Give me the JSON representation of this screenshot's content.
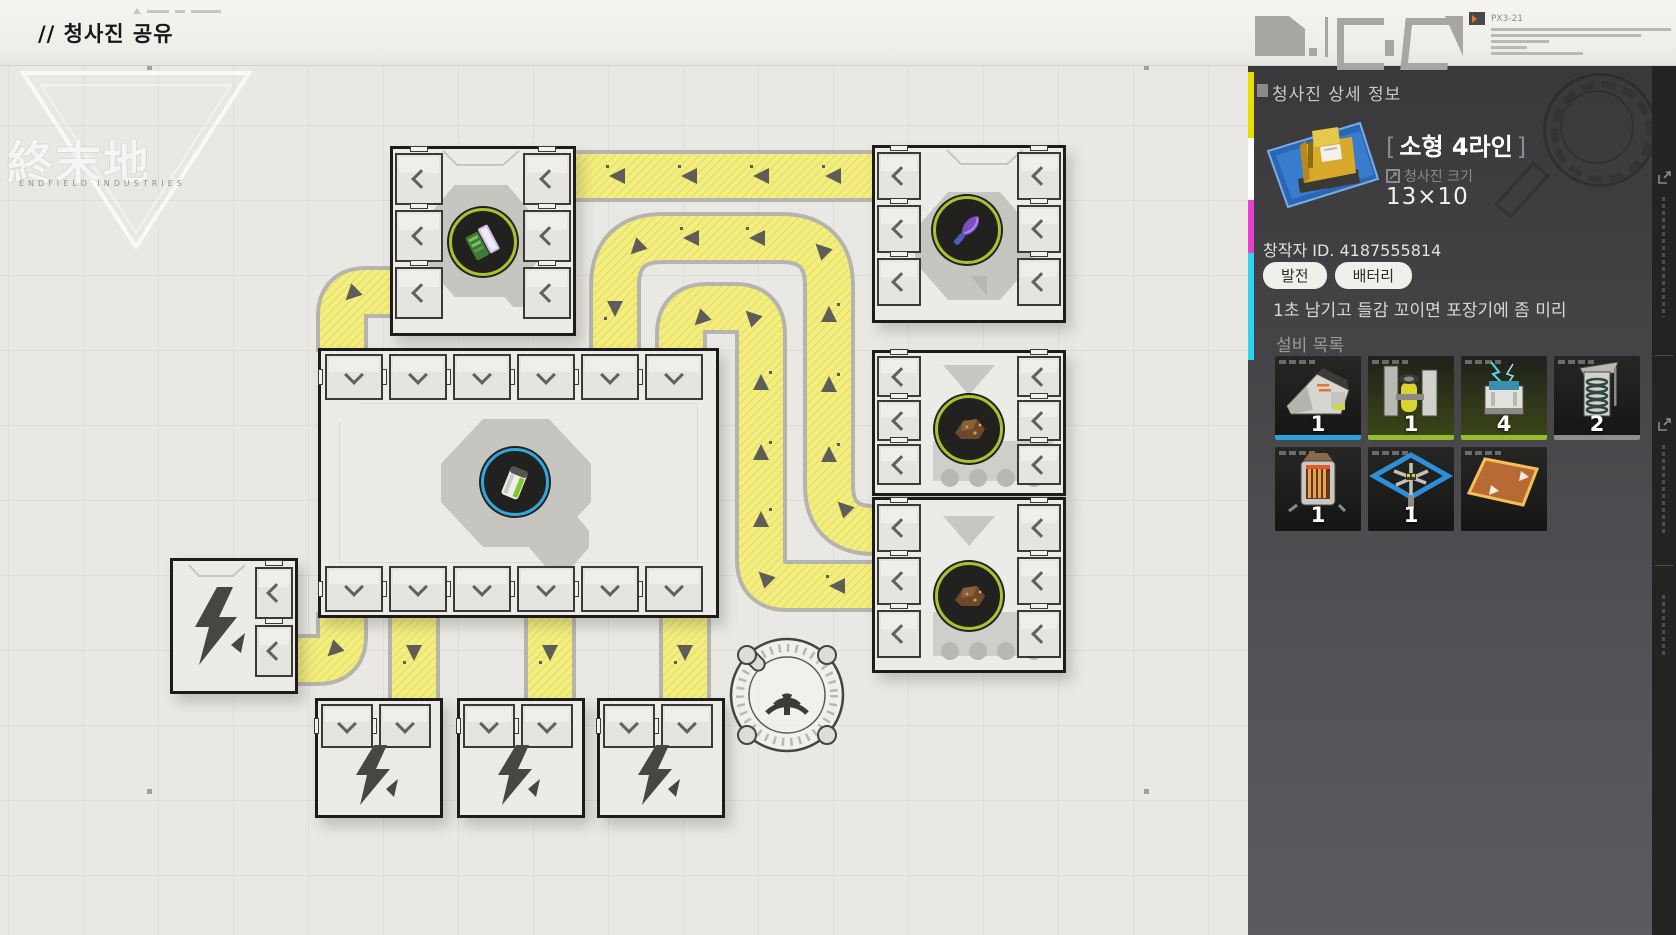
{
  "window": {
    "title": "// 청사진 공유"
  },
  "logo": {
    "cjk": "終末地",
    "subtitle": "ENDFIELD INDUSTRIES"
  },
  "topbar_deco": {
    "code": "PX3-21"
  },
  "panel": {
    "section_title": "청사진 상세 정보",
    "blueprint": {
      "bracket_open": "[",
      "name": "소형 4라인",
      "bracket_close": "]",
      "size_label": "청사진 크기",
      "size_value": "13×10"
    },
    "creator_id": "창작자 ID. 4187555814",
    "tags": [
      "발전",
      "배터리"
    ],
    "description": "1초 남기고 들감 꼬이면 포장기에 좀 미리",
    "equipment_title": "설비 목록",
    "equipment": [
      {
        "name": "crusher",
        "count": "1",
        "bar_color": "#2ba2dc"
      },
      {
        "name": "battery-assembler",
        "count": "1",
        "bar_color": "#96bc2e"
      },
      {
        "name": "generator",
        "count": "4",
        "bar_color": "#96bc2e"
      },
      {
        "name": "storage-tower",
        "count": "2",
        "bar_color": "#8e8e8c"
      },
      {
        "name": "heater",
        "count": "1",
        "bar_color": ""
      },
      {
        "name": "packager",
        "count": "1",
        "bar_color": ""
      },
      {
        "name": "conveyor-patch",
        "count": "",
        "bar_color": ""
      }
    ],
    "accent_bars": [
      "#e8df00",
      "#ffffff",
      "#e83fd0",
      "#2fd4f0"
    ]
  },
  "map": {
    "belt_color": "#f4ee7e",
    "buildings": [
      {
        "name": "assembler-top-left",
        "item": "green-circuit"
      },
      {
        "name": "assembler-top-right",
        "item": "purple-plant"
      },
      {
        "name": "smelter-mid-right",
        "item": "ore"
      },
      {
        "name": "smelter-bottom-right",
        "item": "ore"
      },
      {
        "name": "main-factory-center",
        "item": "battery"
      },
      {
        "name": "power-plant-left",
        "icon": "lightning"
      },
      {
        "name": "power-plant-1",
        "icon": "lightning"
      },
      {
        "name": "power-plant-2",
        "icon": "lightning"
      },
      {
        "name": "power-plant-3",
        "icon": "lightning"
      },
      {
        "name": "signal-tower",
        "icon": "antenna"
      }
    ]
  }
}
